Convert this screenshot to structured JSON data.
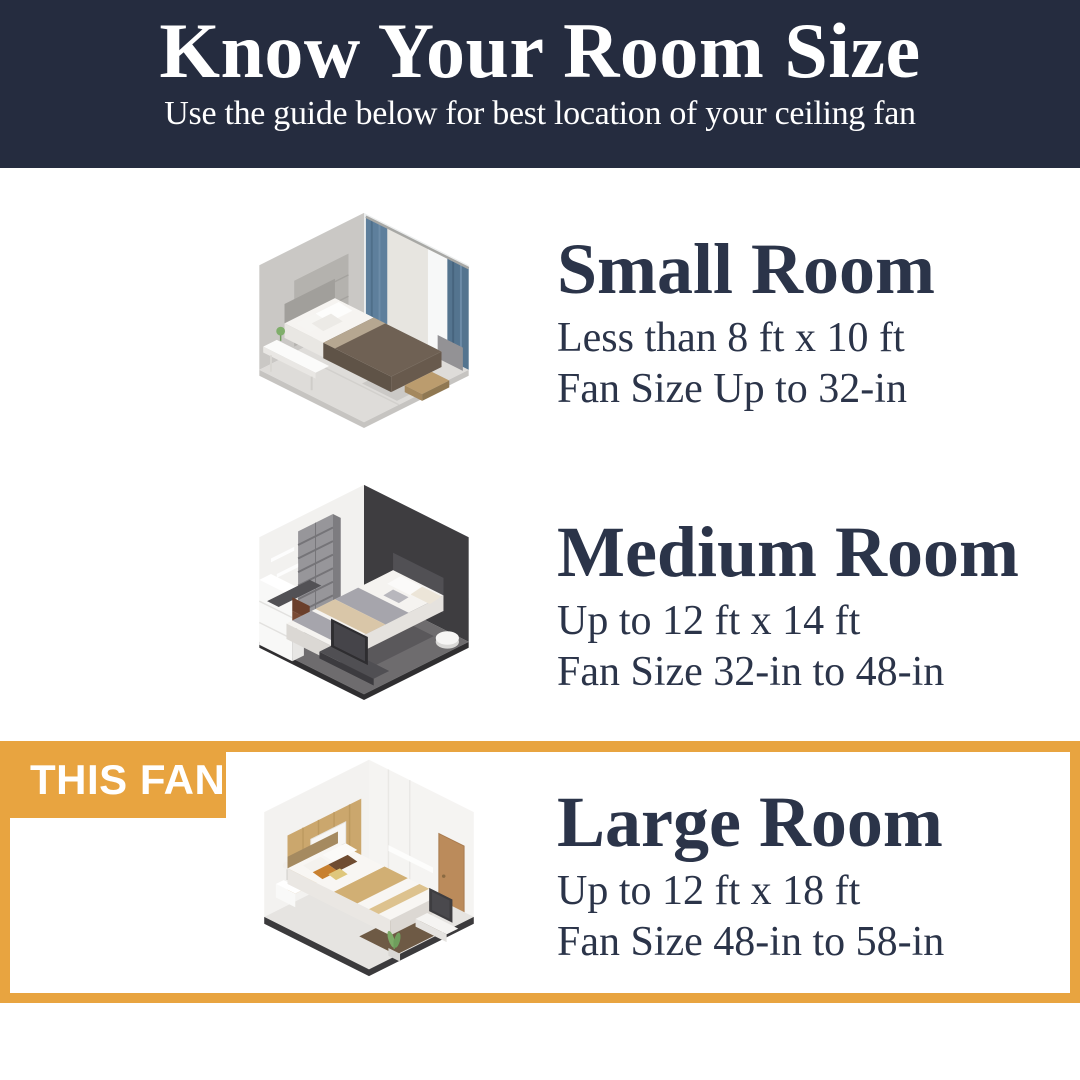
{
  "header": {
    "title": "Know Your Room Size",
    "subtitle": "Use the guide below for best location of your ceiling fan",
    "bg_color": "#252C3F",
    "text_color": "#FFFFFF"
  },
  "sections": [
    {
      "name": "small-room",
      "title": "Small Room",
      "dimensions": "Less than 8 ft x 10 ft",
      "fan_size": "Fan Size Up to 32-in",
      "illustration": "small-bedroom-isometric-render"
    },
    {
      "name": "medium-room",
      "title": "Medium Room",
      "dimensions": "Up to 12 ft x 14 ft",
      "fan_size": "Fan Size 32-in to 48-in",
      "illustration": "medium-bedroom-isometric-render"
    },
    {
      "name": "large-room",
      "title": "Large Room",
      "dimensions": "Up to 12 ft x 18 ft",
      "fan_size": "Fan Size 48-in to 58-in",
      "illustration": "large-bedroom-isometric-render",
      "highlighted": true,
      "badge": "THIS FAN"
    }
  ],
  "accent": {
    "highlight_color": "#E8A440",
    "body_text_color": "#2B3449"
  }
}
